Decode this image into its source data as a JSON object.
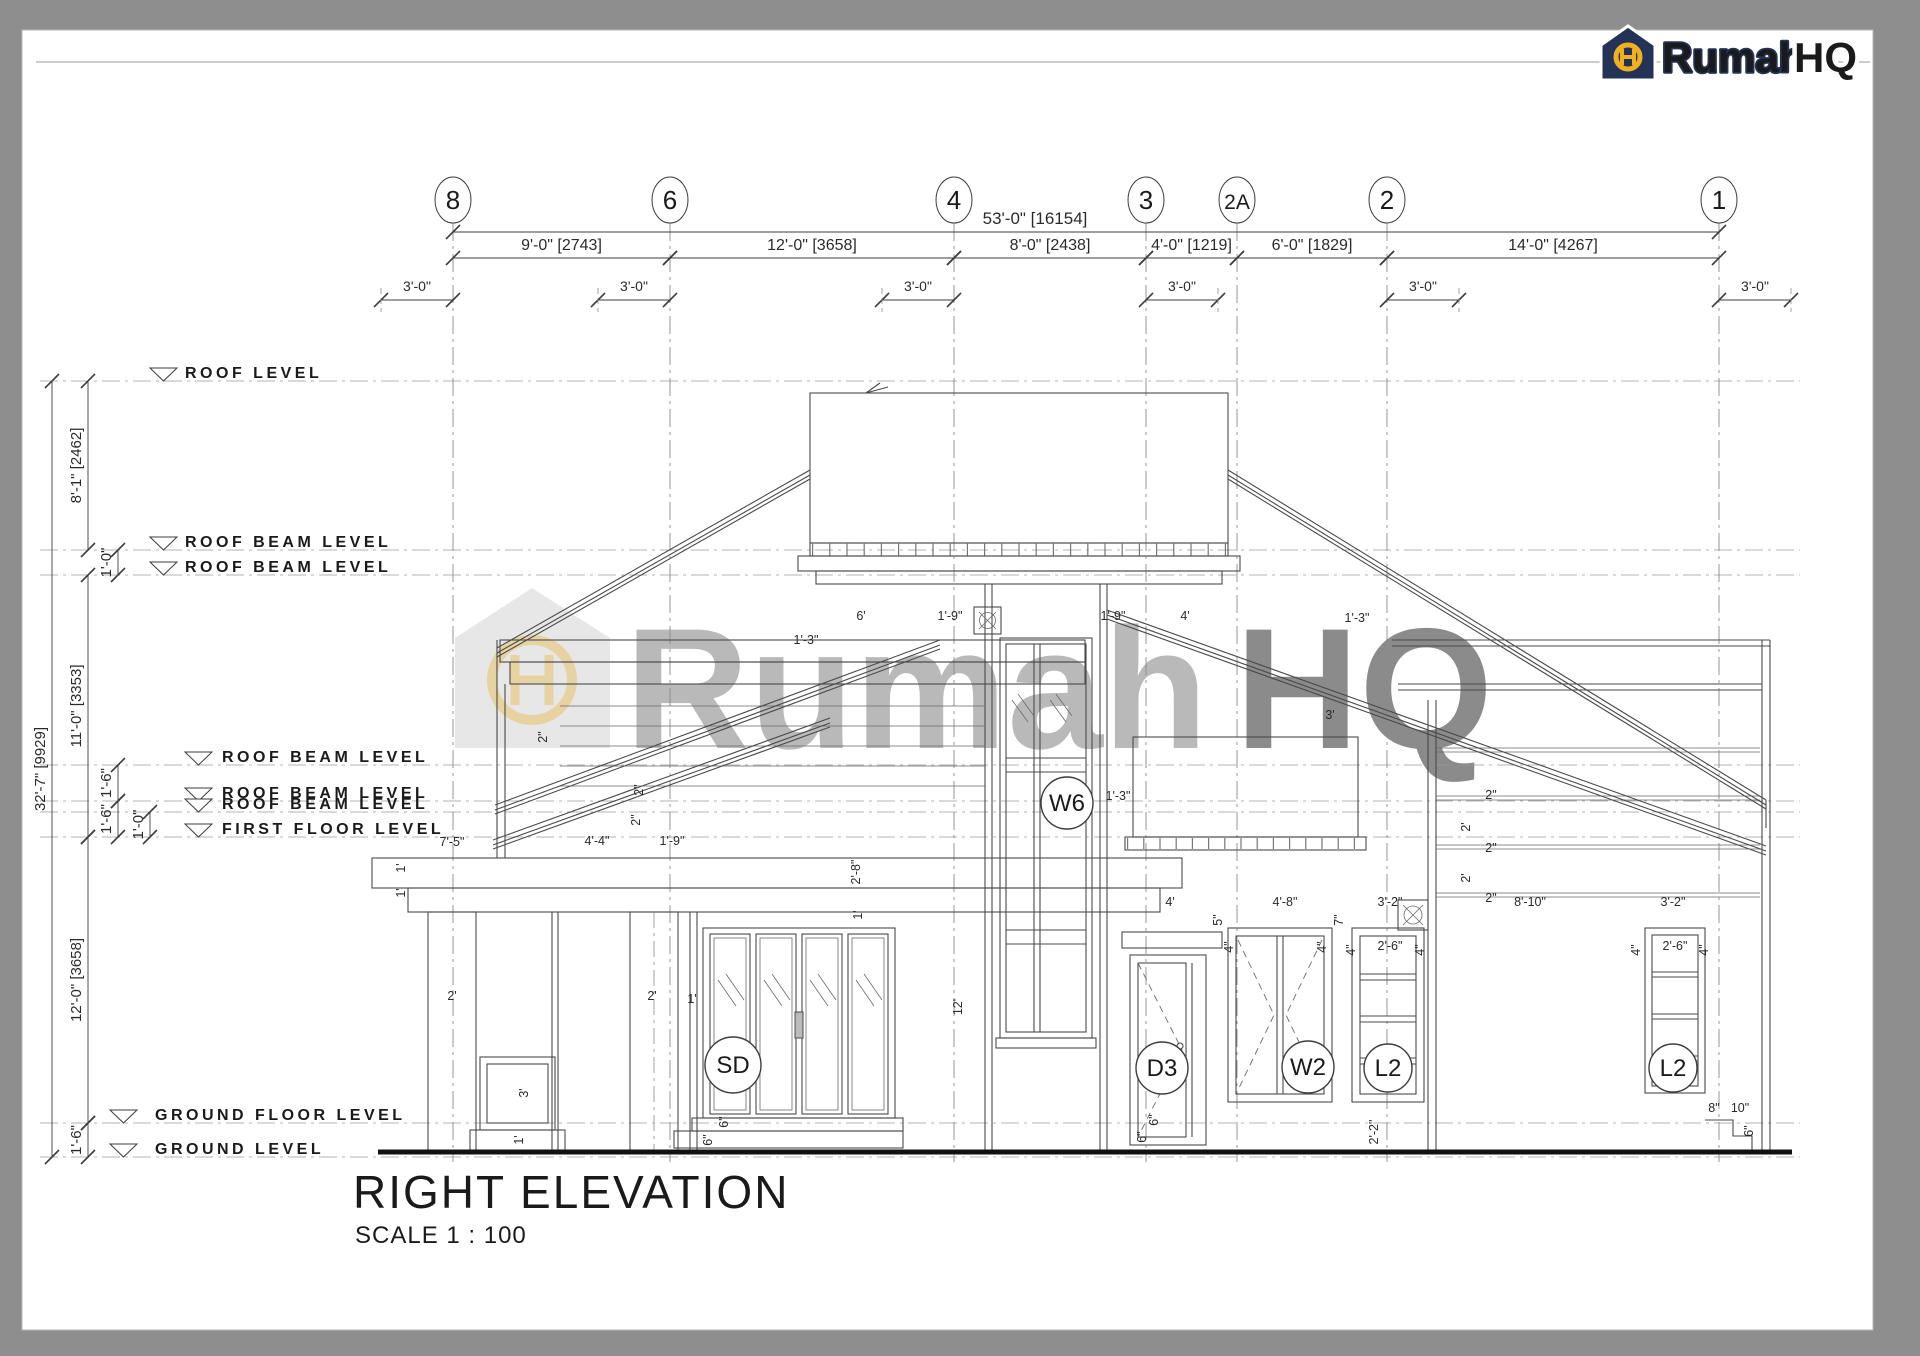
{
  "page": {
    "bg": "#8e8e8e",
    "paper": "#ffffff",
    "line": "#4a4a4a",
    "accent_yellow": "#f1b11f",
    "accent_navy": "#233257"
  },
  "logo": {
    "word1": "Rumah",
    "word2": "HQ",
    "monogram": "H"
  },
  "title": {
    "label": "RIGHT ELEVATION",
    "scale": "SCALE 1 : 100"
  },
  "watermark": {
    "word1": "Rumah",
    "word2": "HQ"
  },
  "grids": [
    {
      "label": "8",
      "x": 453
    },
    {
      "label": "6",
      "x": 670
    },
    {
      "label": "4",
      "x": 954
    },
    {
      "label": "3",
      "x": 1146
    },
    {
      "label": "2A",
      "x": 1237
    },
    {
      "label": "2",
      "x": 1387
    },
    {
      "label": "1",
      "x": 1719
    }
  ],
  "top_dims": {
    "overall": {
      "label": "53'-0\" [16154]",
      "from": 453,
      "to": 1719,
      "y": 232,
      "text_x": 1035,
      "text_y": 224
    },
    "segments_y": 258,
    "segments": [
      {
        "label": "9'-0\" [2743]",
        "from": 453,
        "to": 670
      },
      {
        "label": "12'-0\" [3658]",
        "from": 670,
        "to": 954
      },
      {
        "label": "8'-0\" [2438]",
        "from": 954,
        "to": 1146
      },
      {
        "label": "4'-0\" [1219]",
        "from": 1146,
        "to": 1237
      },
      {
        "label": "6'-0\" [1829]",
        "from": 1237,
        "to": 1387
      },
      {
        "label": "14'-0\" [4267]",
        "from": 1387,
        "to": 1719
      }
    ],
    "subdims_y": 300,
    "subdims": [
      {
        "label": "3'-0\"",
        "grid": 453,
        "side": "left"
      },
      {
        "label": "3'-0\"",
        "grid": 670,
        "side": "left"
      },
      {
        "label": "3'-0\"",
        "grid": 954,
        "side": "left"
      },
      {
        "label": "3'-0\"",
        "grid": 1146,
        "side": "right"
      },
      {
        "label": "3'-0\"",
        "grid": 1387,
        "side": "right"
      },
      {
        "label": "3'-0\"",
        "grid": 1719,
        "side": "right"
      }
    ]
  },
  "levels": [
    {
      "label": "ROOF LEVEL",
      "y": 381,
      "tx": 150,
      "lx": 185
    },
    {
      "label": "ROOF BEAM LEVEL",
      "y": 550,
      "tx": 150,
      "lx": 185
    },
    {
      "label": "ROOF BEAM LEVEL",
      "y": 575,
      "tx": 150,
      "lx": 185
    },
    {
      "label": "ROOF BEAM LEVEL",
      "y": 765,
      "tx": 185,
      "lx": 222
    },
    {
      "label": "ROOF BEAM LEVEL",
      "y": 801,
      "tx": 185,
      "lx": 222
    },
    {
      "label": "ROOF BEAM LEVEL",
      "y": 812,
      "tx": 185,
      "lx": 222
    },
    {
      "label": "FIRST FLOOR LEVEL",
      "y": 837,
      "tx": 185,
      "lx": 222
    },
    {
      "label": "GROUND FLOOR LEVEL",
      "y": 1123,
      "tx": 110,
      "lx": 155
    },
    {
      "label": "GROUND  LEVEL",
      "y": 1157,
      "tx": 110,
      "lx": 155
    }
  ],
  "left_dims": [
    {
      "label": "32'-7\" [9929]",
      "x": 52,
      "from": 381,
      "to": 1157
    },
    {
      "label": "8'-1\" [2462]",
      "x": 88,
      "from": 381,
      "to": 550
    },
    {
      "label": "1'-0\"",
      "x": 118,
      "from": 550,
      "to": 575
    },
    {
      "label": "11'-0\" [3353]",
      "x": 88,
      "from": 575,
      "to": 837
    },
    {
      "label": "1'-6\"",
      "x": 118,
      "from": 765,
      "to": 801
    },
    {
      "label": "1'-6\"",
      "x": 118,
      "from": 801,
      "to": 837
    },
    {
      "label": "1'-0\"",
      "x": 150,
      "from": 812,
      "to": 837
    },
    {
      "label": "12'-0\" [3658]",
      "x": 88,
      "from": 837,
      "to": 1123
    },
    {
      "label": "1'-6\"",
      "x": 88,
      "from": 1123,
      "to": 1157
    }
  ],
  "tags": [
    {
      "label": "SD",
      "cx": 733,
      "cy": 1065,
      "r": 28
    },
    {
      "label": "W6",
      "cx": 1067,
      "cy": 803,
      "r": 26
    },
    {
      "label": "D3",
      "cx": 1162,
      "cy": 1068,
      "r": 26
    },
    {
      "label": "W2",
      "cx": 1308,
      "cy": 1067,
      "r": 26
    },
    {
      "label": "L2",
      "cx": 1388,
      "cy": 1068,
      "r": 24
    },
    {
      "label": "L2",
      "cx": 1673,
      "cy": 1068,
      "r": 24
    }
  ],
  "annotations": [
    {
      "x": 861,
      "y": 620,
      "t": "6'"
    },
    {
      "x": 950,
      "y": 620,
      "t": "1'-9\""
    },
    {
      "x": 1113,
      "y": 620,
      "t": "1'-9\""
    },
    {
      "x": 1185,
      "y": 620,
      "t": "4'"
    },
    {
      "x": 806,
      "y": 644,
      "t": "1'-3\""
    },
    {
      "x": 1357,
      "y": 622,
      "t": "1'-3\""
    },
    {
      "x": 1330,
      "y": 719,
      "t": "3'"
    },
    {
      "x": 1118,
      "y": 800,
      "t": "1'-3\""
    },
    {
      "x": 452,
      "y": 846,
      "t": "7'-5\""
    },
    {
      "x": 597,
      "y": 845,
      "t": "4'-4\""
    },
    {
      "x": 672,
      "y": 845,
      "t": "1'-9\""
    },
    {
      "x": 405,
      "y": 868,
      "t": "1'",
      "r": 1
    },
    {
      "x": 405,
      "y": 893,
      "t": "1'",
      "r": 1
    },
    {
      "x": 452,
      "y": 1000,
      "t": "2'"
    },
    {
      "x": 652,
      "y": 1000,
      "t": "2'"
    },
    {
      "x": 692,
      "y": 1003,
      "t": "1'"
    },
    {
      "x": 528,
      "y": 1093,
      "t": "3'",
      "r": 1
    },
    {
      "x": 523,
      "y": 1140,
      "t": "1'",
      "r": 1
    },
    {
      "x": 962,
      "y": 1007,
      "t": "12'",
      "r": 1
    },
    {
      "x": 728,
      "y": 1122,
      "t": "6\"",
      "r": 1
    },
    {
      "x": 712,
      "y": 1140,
      "t": "6\"",
      "r": 1
    },
    {
      "x": 547,
      "y": 737,
      "t": "2\"",
      "r": 1
    },
    {
      "x": 643,
      "y": 790,
      "t": "2\"",
      "r": 1
    },
    {
      "x": 640,
      "y": 820,
      "t": "2\"",
      "r": 1
    },
    {
      "x": 860,
      "y": 872,
      "t": "2'-8\"",
      "r": 1
    },
    {
      "x": 862,
      "y": 915,
      "t": "1'",
      "r": 1
    },
    {
      "x": 1170,
      "y": 906,
      "t": "4'"
    },
    {
      "x": 1285,
      "y": 906,
      "t": "4'-8\""
    },
    {
      "x": 1390,
      "y": 906,
      "t": "3'-2\""
    },
    {
      "x": 1222,
      "y": 920,
      "t": "5\"",
      "r": 1
    },
    {
      "x": 1343,
      "y": 920,
      "t": "7\"",
      "r": 1
    },
    {
      "x": 1233,
      "y": 947,
      "t": "4\"",
      "r": 1
    },
    {
      "x": 1326,
      "y": 947,
      "t": "4\"",
      "r": 1
    },
    {
      "x": 1355,
      "y": 950,
      "t": "4\"",
      "r": 1
    },
    {
      "x": 1390,
      "y": 950,
      "t": "2'-6\""
    },
    {
      "x": 1424,
      "y": 950,
      "t": "4\"",
      "r": 1
    },
    {
      "x": 1378,
      "y": 1132,
      "t": "2'-2\"",
      "r": 1
    },
    {
      "x": 1158,
      "y": 1120,
      "t": "6\"",
      "r": 1
    },
    {
      "x": 1146,
      "y": 1137,
      "t": "6\"",
      "r": 1
    },
    {
      "x": 1530,
      "y": 906,
      "t": "8'-10\""
    },
    {
      "x": 1673,
      "y": 906,
      "t": "3'-2\""
    },
    {
      "x": 1640,
      "y": 950,
      "t": "4\"",
      "r": 1
    },
    {
      "x": 1675,
      "y": 950,
      "t": "2'-6\""
    },
    {
      "x": 1708,
      "y": 950,
      "t": "4\"",
      "r": 1
    },
    {
      "x": 1491,
      "y": 799,
      "t": "2\""
    },
    {
      "x": 1470,
      "y": 827,
      "t": "2'",
      "r": 1
    },
    {
      "x": 1491,
      "y": 852,
      "t": "2\""
    },
    {
      "x": 1470,
      "y": 878,
      "t": "2'",
      "r": 1
    },
    {
      "x": 1491,
      "y": 902,
      "t": "2\""
    },
    {
      "x": 1714,
      "y": 1112,
      "t": "8\""
    },
    {
      "x": 1740,
      "y": 1112,
      "t": "10\""
    },
    {
      "x": 1753,
      "y": 1131,
      "t": "6\"",
      "r": 1
    }
  ]
}
